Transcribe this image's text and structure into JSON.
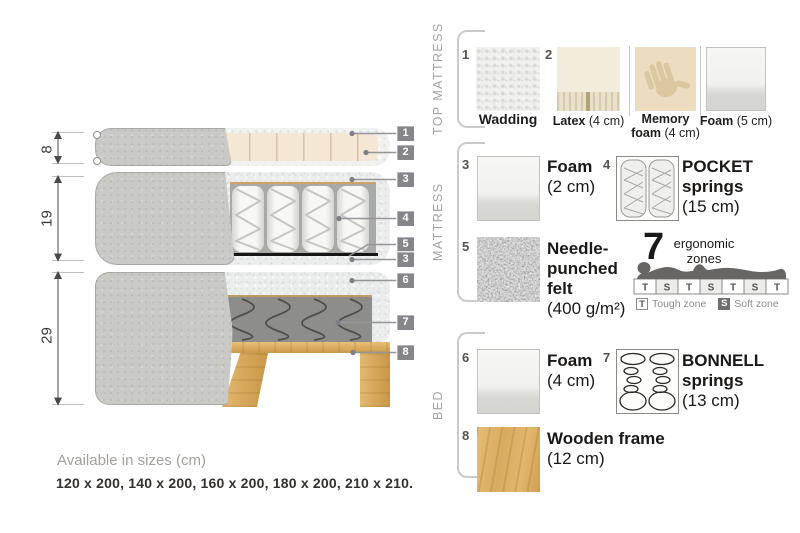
{
  "diagram": {
    "heights": [
      "8",
      "19",
      "29"
    ],
    "callouts": [
      "1",
      "2",
      "3",
      "4",
      "5",
      "3",
      "6",
      "7",
      "8"
    ]
  },
  "panel": {
    "sections": [
      {
        "label": "TOP MATTRESS",
        "items": [
          {
            "num": "1",
            "name": "Wadding",
            "size": ""
          },
          {
            "num": "2",
            "name": "Latex",
            "size": "(4 cm)"
          },
          {
            "num": "",
            "name": "Memory foam",
            "size": "(4 cm)"
          },
          {
            "num": "",
            "name": "Foam",
            "size": "(5 cm)"
          }
        ]
      },
      {
        "label": "MATTRESS",
        "items": [
          {
            "num": "3",
            "name": "Foam",
            "size": "(2 cm)"
          },
          {
            "num": "4",
            "name": "POCKET springs",
            "size": "(15 cm)"
          },
          {
            "num": "5",
            "name": "Needle-punched felt",
            "size": "(400 g/m²)"
          }
        ],
        "ergonomic": {
          "count": "7",
          "label": "ergonomic",
          "label2": "zones",
          "zones": [
            "T",
            "S",
            "T",
            "S",
            "T",
            "S",
            "T"
          ],
          "legend": [
            {
              "letter": "T",
              "text": "Tough zone"
            },
            {
              "letter": "S",
              "text": "Soft zone"
            }
          ]
        }
      },
      {
        "label": "BED",
        "items": [
          {
            "num": "6",
            "name": "Foam",
            "size": "(4 cm)"
          },
          {
            "num": "7",
            "name": "BONNELL springs",
            "size": "(13 cm)"
          },
          {
            "num": "8",
            "name": "Wooden frame",
            "size": "(12 cm)"
          }
        ]
      }
    ]
  },
  "footer": {
    "title": "Available in sizes (cm)",
    "sizes": "120 x 200, 140 x 200, 160 x 200, 180 x 200, 210 x 210."
  }
}
